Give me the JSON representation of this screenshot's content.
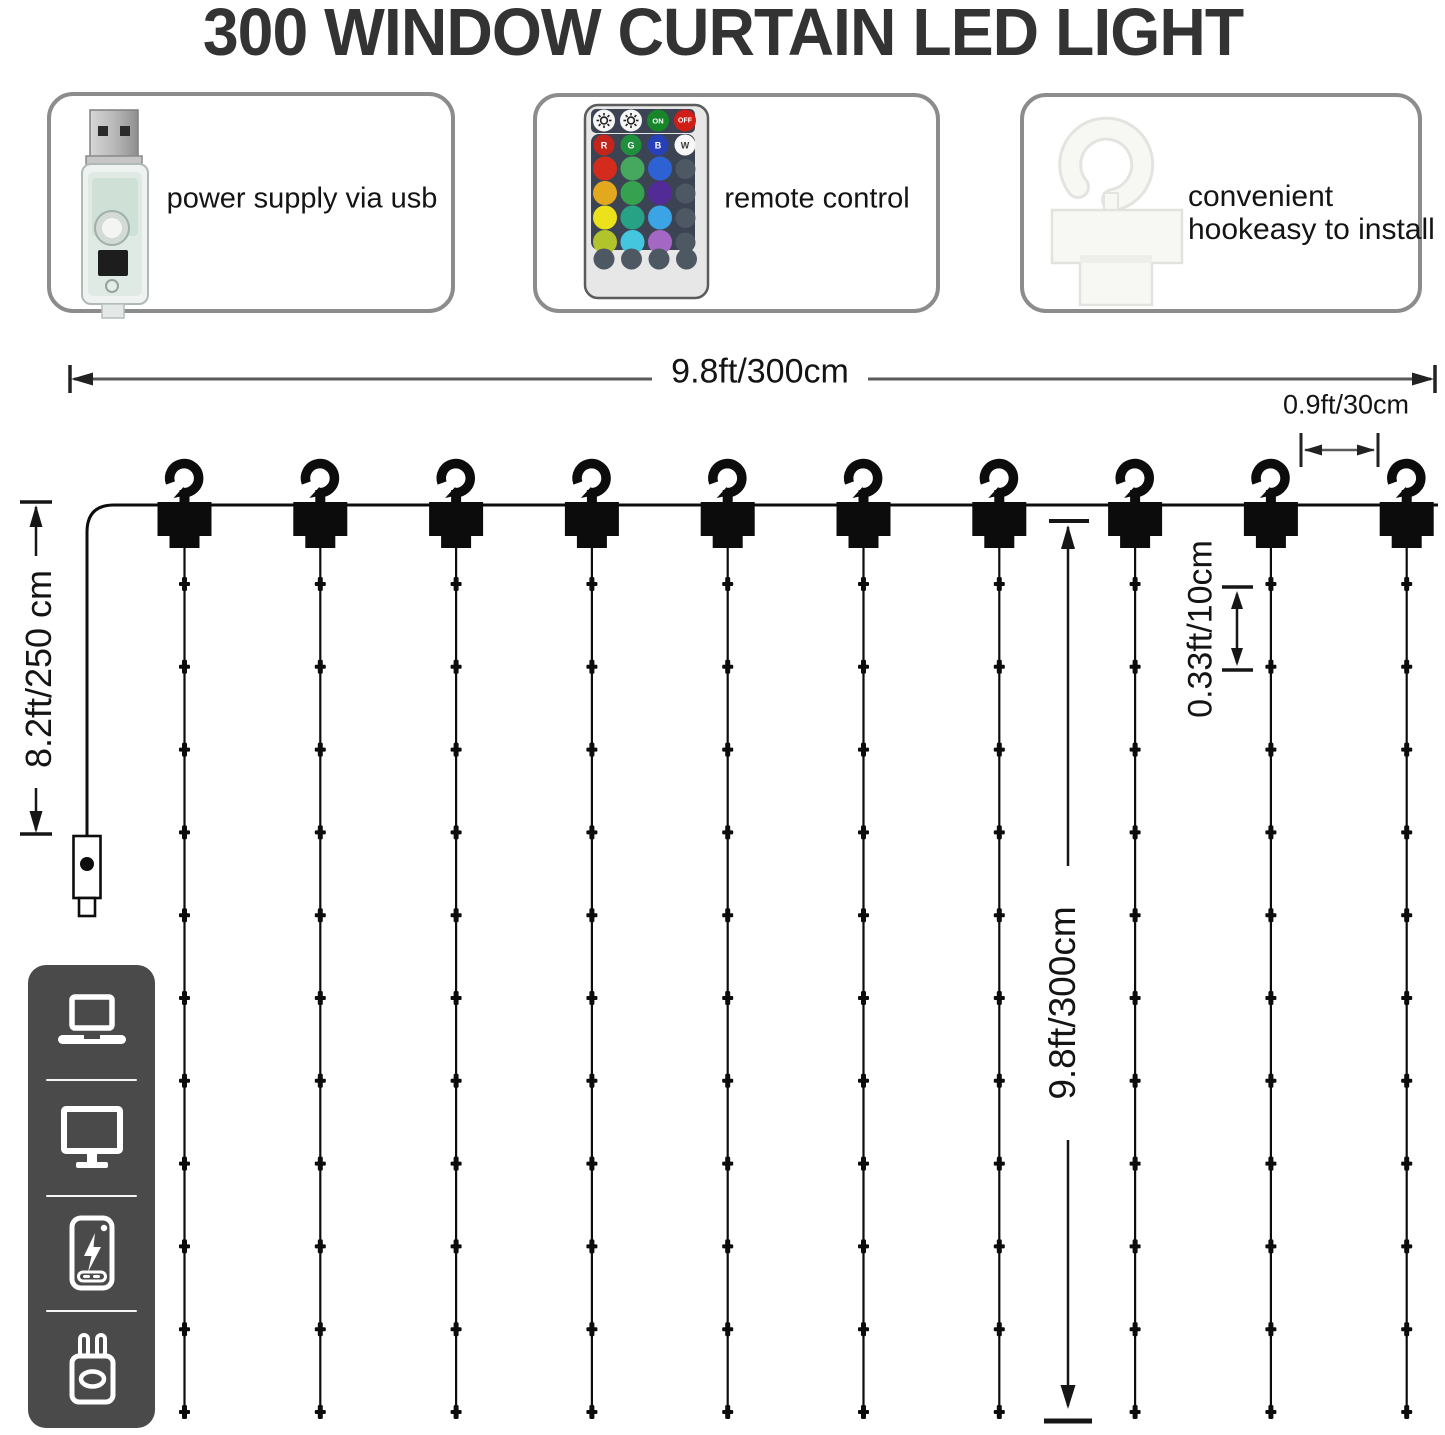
{
  "title": "300 WINDOW CURTAIN LED LIGHT",
  "features": [
    {
      "name": "usb-power",
      "label": "power supply via usb"
    },
    {
      "name": "remote-control",
      "label": "remote control"
    },
    {
      "name": "hanging-hook",
      "label_line1": "convenient",
      "label_line2": "hookeasy to install"
    }
  ],
  "dimensions": {
    "curtain_width": "9.8ft/300cm",
    "hook_spacing": "0.9ft/30cm",
    "power_cord_length": "8.2ft/250 cm",
    "curtain_drop": "9.8ft/300cm",
    "led_spacing": "0.33ft/10cm"
  },
  "remote_buttons": {
    "on": "ON",
    "off": "OFF",
    "red": "R",
    "green": "G",
    "blue": "B",
    "white": "W"
  },
  "diagram": {
    "hook_count": 10,
    "led_strings": 10,
    "leds_per_string": 11
  },
  "compatibility_icons": [
    "laptop",
    "monitor",
    "power-bank",
    "usb-wall-charger"
  ],
  "colors": {
    "title": "#333333",
    "line": "#111111",
    "thin_line": "#5a5a5a",
    "box_border": "#8c8c8c",
    "sidebar_bg": "#4a4a4a"
  }
}
